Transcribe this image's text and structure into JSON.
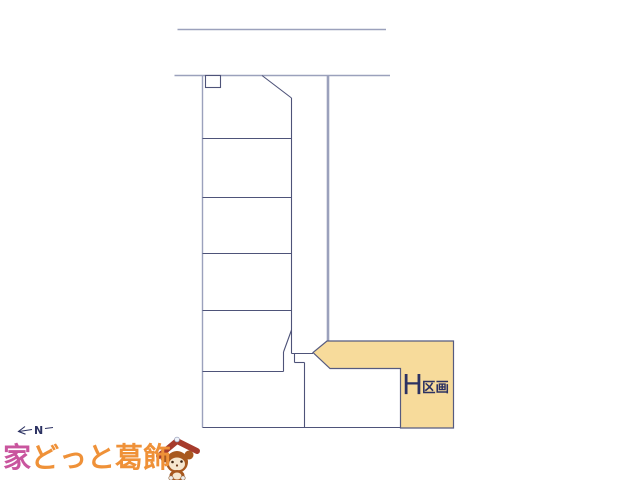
{
  "canvas": {
    "width": 640,
    "height": 480,
    "background": "#ffffff"
  },
  "colors": {
    "plot_line": "#4e5379",
    "road_line": "#9ba1bc",
    "highlight_fill": "#f7db9b",
    "highlight_stroke": "#565b80",
    "label_text": "#2c3262",
    "logo_pink": "#c9559e",
    "logo_orange": "#ef9138",
    "mascot_roof": "#a63b2c",
    "mascot_body": "#a8591f",
    "mascot_face": "#f6e7cf"
  },
  "highlight_plot": {
    "label_main": "H",
    "label_sub": "区画"
  },
  "compass": {
    "label": "N"
  },
  "logo": {
    "text_primary": "家",
    "text_secondary": "どっと葛飾",
    "mascot": "house-roof-mascot"
  }
}
